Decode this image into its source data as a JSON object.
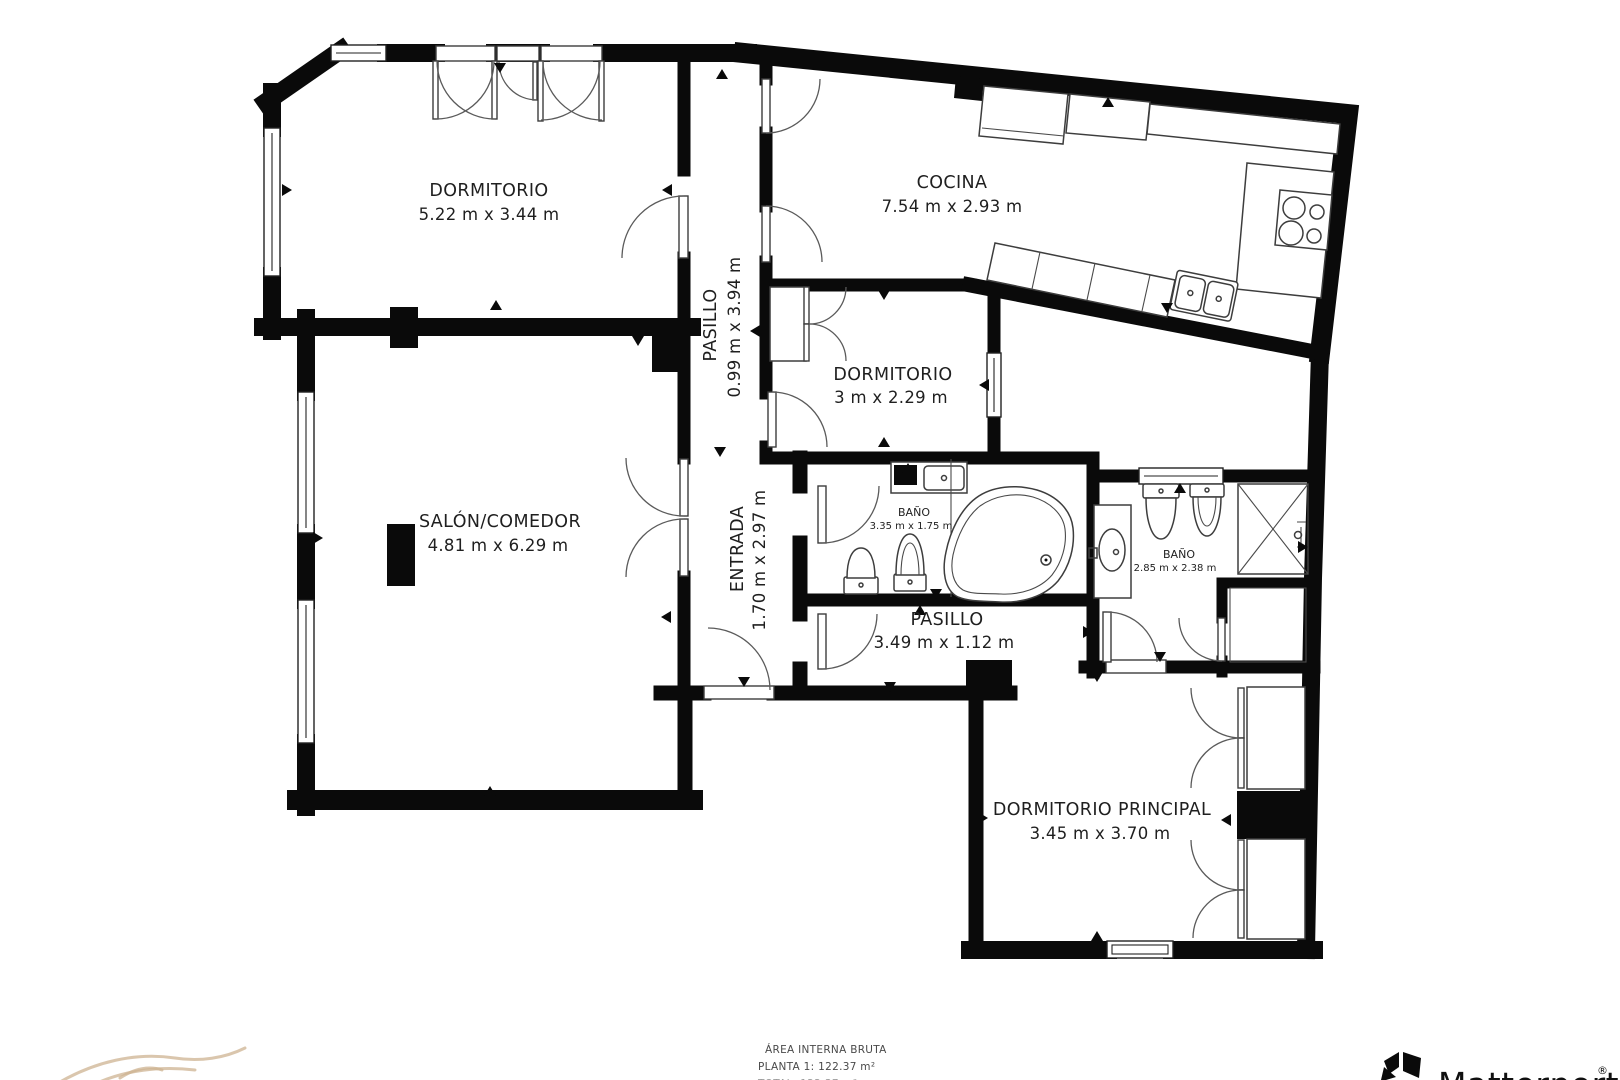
{
  "plan": {
    "rooms": [
      {
        "label": "DORMITORIO",
        "dims": "5.22 m x 3.44 m"
      },
      {
        "label": "COCINA",
        "dims": "7.54 m x 2.93 m"
      },
      {
        "label": "PASILLO",
        "dims": "0.99 m x 3.94 m"
      },
      {
        "label": "DORMITORIO",
        "dims": "3 m x 2.29 m"
      },
      {
        "label": "SALÓN/COMEDOR",
        "dims": "4.81 m x 6.29 m"
      },
      {
        "label": "ENTRADA",
        "dims": "1.70 m x 2.97 m"
      },
      {
        "label": "BAÑO",
        "dims": "3.35 m x 1.75 m"
      },
      {
        "label": "BAÑO",
        "dims": "2.85 m x 2.38 m"
      },
      {
        "label": "PASILLO",
        "dims": "3.49 m x 1.12 m"
      },
      {
        "label": "DORMITORIO PRINCIPAL",
        "dims": "3.45 m x 3.70 m"
      }
    ]
  },
  "footer": {
    "area_title": "ÁREA INTERNA BRUTA",
    "area_planta": "PLANTA 1: 122.37 m²",
    "area_total": "TOTAL: 122.37 m²"
  },
  "branding": {
    "name": "Matterport",
    "registered": "®"
  },
  "colors": {
    "wall": "#0a0a0a",
    "fixture_line": "#3d3d3d",
    "label_text": "#1f1f1f",
    "footer_text": "#4a4a4a",
    "partner_logo_tan": "#cdb391"
  }
}
